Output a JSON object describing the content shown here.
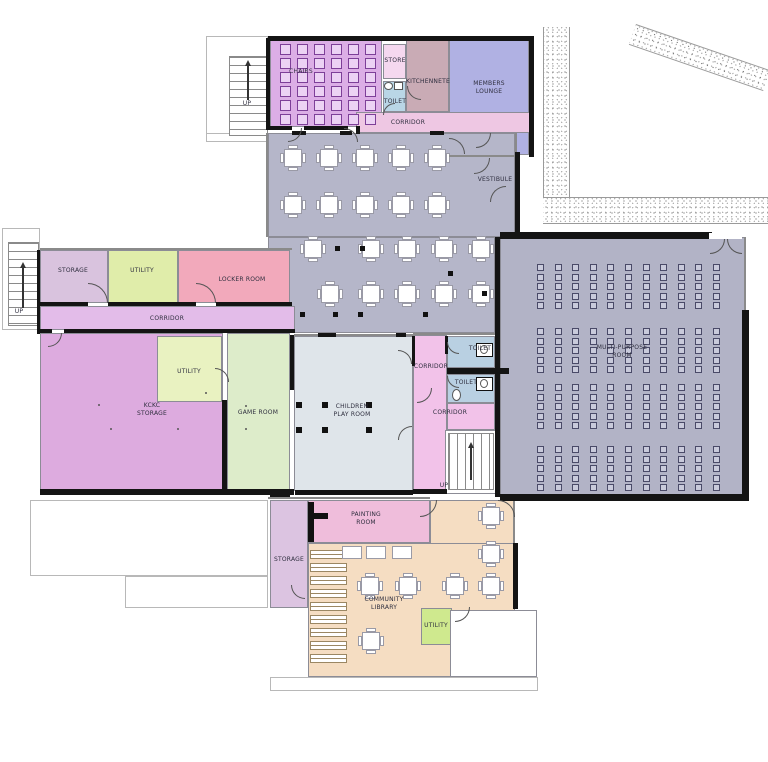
{
  "meta": {
    "width": 768,
    "height": 762,
    "description": "Ground floor plan of a community centre"
  },
  "palette": {
    "hall": "#b5b6c9",
    "multi_purpose": "#b2b3c6",
    "corridor_pink": "#eec7e3",
    "wall": "#141414"
  },
  "rooms": [
    {
      "id": "chairs-room",
      "label": "CHAIRS",
      "x": 270,
      "y": 39,
      "w": 112,
      "h": 88,
      "fill": "#dcaee6",
      "lx": 301,
      "ly": 72
    },
    {
      "id": "store",
      "label": "STORE",
      "x": 383,
      "y": 44,
      "w": 23,
      "h": 35,
      "fill": "#f5d8ef",
      "lx": 395,
      "ly": 61
    },
    {
      "id": "toilet-top",
      "label": "TOILET",
      "x": 383,
      "y": 81,
      "w": 23,
      "h": 31,
      "fill": "#b9d6e6",
      "lx": 395,
      "ly": 102
    },
    {
      "id": "kitchenette",
      "label": "KITCHENNETE",
      "x": 406,
      "y": 40,
      "w": 43,
      "h": 72,
      "fill": "#c9abb5",
      "lx": 428,
      "ly": 82
    },
    {
      "id": "members-lounge",
      "label": "MEMBERS\nLOUNGE",
      "x": 449,
      "y": 40,
      "w": 80,
      "h": 115,
      "fill": "#b0b1e3",
      "lx": 489,
      "ly": 88
    },
    {
      "id": "corridor-top",
      "label": "CORRIDOR",
      "x": 356,
      "y": 112,
      "w": 174,
      "h": 21,
      "fill": "#eec7e3",
      "lx": 408,
      "ly": 123
    },
    {
      "id": "vestibule",
      "label": "VESTIBULE",
      "x": 472,
      "y": 157,
      "w": 46,
      "h": 46,
      "fill": "#f0a2d7",
      "lx": 495,
      "ly": 180
    },
    {
      "id": "hall-upper",
      "label": "",
      "x": 268,
      "y": 133,
      "w": 247,
      "h": 104,
      "fill": "#b5b6c9"
    },
    {
      "id": "hall-lower",
      "label": "",
      "x": 268,
      "y": 237,
      "w": 227,
      "h": 96,
      "fill": "#b5b6c9"
    },
    {
      "id": "multi-purpose-room",
      "label": "MULTI-PURPOSE\nROOM",
      "x": 500,
      "y": 237,
      "w": 245,
      "h": 258,
      "fill": "#b2b3c6",
      "lx": 622,
      "ly": 352
    },
    {
      "id": "storage-mid",
      "label": "STORAGE",
      "x": 40,
      "y": 250,
      "w": 68,
      "h": 53,
      "fill": "#d9c3de",
      "lx": 73,
      "ly": 271
    },
    {
      "id": "utility-mid",
      "label": "UTILITY",
      "x": 108,
      "y": 250,
      "w": 70,
      "h": 53,
      "fill": "#e0edaa",
      "lx": 142,
      "ly": 271
    },
    {
      "id": "locker-room",
      "label": "LOCKER ROOM",
      "x": 178,
      "y": 250,
      "w": 112,
      "h": 53,
      "fill": "#f2a9bb",
      "lx": 242,
      "ly": 280
    },
    {
      "id": "corridor-mid",
      "label": "CORRIDOR",
      "x": 40,
      "y": 306,
      "w": 255,
      "h": 24,
      "fill": "#e3bce9",
      "lx": 167,
      "ly": 319
    },
    {
      "id": "kckc-storage",
      "label": "KCKC\nSTORAGE",
      "x": 40,
      "y": 333,
      "w": 183,
      "h": 157,
      "fill": "#ddabdf",
      "lx": 152,
      "ly": 410
    },
    {
      "id": "utility-kckc",
      "label": "UTILITY",
      "x": 157,
      "y": 336,
      "w": 65,
      "h": 66,
      "fill": "#e9f2c1",
      "lx": 189,
      "ly": 372
    },
    {
      "id": "game-room",
      "label": "GAME ROOM",
      "x": 227,
      "y": 333,
      "w": 63,
      "h": 157,
      "fill": "#ddecca",
      "lx": 258,
      "ly": 413
    },
    {
      "id": "children-play-room",
      "label": "CHILDREN\nPLAY ROOM",
      "x": 294,
      "y": 336,
      "w": 119,
      "h": 155,
      "fill": "#dfe5ea",
      "lx": 352,
      "ly": 411
    },
    {
      "id": "corridor-vertical",
      "label": "CORRIDOR",
      "x": 413,
      "y": 335,
      "w": 34,
      "h": 158,
      "fill": "#f2c2e9",
      "lx": 431,
      "ly": 367
    },
    {
      "id": "toilet-upper",
      "label": "TOILET",
      "x": 447,
      "y": 336,
      "w": 48,
      "h": 32,
      "fill": "#b9d0e2",
      "lx": 480,
      "ly": 349
    },
    {
      "id": "toilet-lower",
      "label": "TOILET",
      "x": 447,
      "y": 374,
      "w": 48,
      "h": 29,
      "fill": "#b9d0e2",
      "lx": 466,
      "ly": 383
    },
    {
      "id": "corridor-lower",
      "label": "CORRIDOR",
      "x": 447,
      "y": 403,
      "w": 48,
      "h": 27,
      "fill": "#f2c2e9",
      "lx": 450,
      "ly": 413
    },
    {
      "id": "stair-room",
      "label": "",
      "x": 445,
      "y": 430,
      "w": 52,
      "h": 64,
      "fill": "#ffffff"
    },
    {
      "id": "painting-room",
      "label": "PAINTING\nROOM",
      "x": 308,
      "y": 500,
      "w": 122,
      "h": 43,
      "fill": "#efbddb",
      "lx": 366,
      "ly": 519
    },
    {
      "id": "storage-bottom",
      "label": "STORAGE",
      "x": 270,
      "y": 500,
      "w": 38,
      "h": 108,
      "fill": "#dcc4e1",
      "lx": 289,
      "ly": 560
    },
    {
      "id": "community-library",
      "label": "COMMUNITY\nLIBRARY",
      "x": 308,
      "y": 543,
      "w": 207,
      "h": 134,
      "fill": "#f5ddc2",
      "lx": 384,
      "ly": 604
    },
    {
      "id": "library-arm",
      "label": "",
      "x": 430,
      "y": 500,
      "w": 85,
      "h": 44,
      "fill": "#f5ddc2"
    },
    {
      "id": "utility-bottom",
      "label": "UTILITY",
      "x": 421,
      "y": 608,
      "w": 31,
      "h": 37,
      "fill": "#cfe98e",
      "lx": 436,
      "ly": 626
    },
    {
      "id": "white-room",
      "label": "",
      "x": 450,
      "y": 610,
      "w": 87,
      "h": 67,
      "fill": "#ffffff"
    }
  ],
  "texts": [
    {
      "id": "up-top",
      "label": "UP",
      "x": 247,
      "y": 104
    },
    {
      "id": "up-left",
      "label": "UP",
      "x": 19,
      "y": 312
    },
    {
      "id": "up-bottom",
      "label": "UP",
      "x": 444,
      "y": 486
    }
  ],
  "decks": [
    [
      206,
      36,
      62,
      102
    ],
    [
      2,
      228,
      38,
      102
    ],
    [
      30,
      500,
      238,
      76
    ],
    [
      125,
      576,
      143,
      32
    ],
    [
      270,
      677,
      268,
      14
    ],
    [
      310,
      666,
      68,
      12
    ],
    [
      206,
      133,
      63,
      9
    ]
  ],
  "masks": [
    [
      709,
      233,
      33,
      6
    ]
  ],
  "stipples": [
    {
      "x": 543,
      "y": 27,
      "w": 27,
      "h": 176,
      "rot": 0,
      "edges": "lr"
    },
    {
      "x": 543,
      "y": 197,
      "w": 225,
      "h": 27,
      "rot": 0,
      "edges": "tb"
    },
    {
      "x": 636,
      "y": 24,
      "w": 142,
      "h": 22,
      "rot": 19,
      "edges": "tb"
    }
  ],
  "walls": [
    [
      268,
      36,
      264,
      5
    ],
    [
      529,
      36,
      5,
      121
    ],
    [
      515,
      152,
      5,
      85
    ],
    [
      266,
      38,
      4,
      92
    ],
    [
      266,
      126,
      26,
      4
    ],
    [
      304,
      126,
      44,
      4
    ],
    [
      356,
      126,
      4,
      8
    ],
    [
      292,
      131,
      14,
      4
    ],
    [
      340,
      131,
      12,
      4
    ],
    [
      430,
      131,
      14,
      4
    ],
    [
      40,
      302,
      48,
      4
    ],
    [
      108,
      302,
      88,
      4
    ],
    [
      216,
      302,
      76,
      4
    ],
    [
      40,
      329,
      12,
      4
    ],
    [
      64,
      329,
      231,
      4
    ],
    [
      37,
      250,
      3,
      84
    ],
    [
      222,
      400,
      5,
      95
    ],
    [
      290,
      335,
      4,
      55
    ],
    [
      40,
      489,
      254,
      6
    ],
    [
      295,
      490,
      118,
      5
    ],
    [
      413,
      489,
      34,
      5
    ],
    [
      500,
      232,
      212,
      7
    ],
    [
      500,
      494,
      249,
      7
    ],
    [
      742,
      310,
      7,
      191
    ],
    [
      495,
      237,
      5,
      260
    ],
    [
      447,
      368,
      62,
      6
    ],
    [
      412,
      336,
      3,
      30
    ],
    [
      445,
      336,
      3,
      18
    ],
    [
      270,
      492,
      20,
      5
    ],
    [
      513,
      543,
      5,
      66
    ],
    [
      318,
      333,
      18,
      4
    ],
    [
      396,
      333,
      10,
      4
    ]
  ],
  "thinlines": [
    [
      744,
      237,
      2,
      76
    ],
    [
      266,
      133,
      2,
      104
    ],
    [
      40,
      248,
      252,
      2
    ],
    [
      449,
      155,
      68,
      2
    ],
    [
      294,
      334,
      120,
      2
    ],
    [
      413,
      333,
      82,
      2
    ],
    [
      515,
      133,
      2,
      22
    ],
    [
      268,
      497,
      162,
      2
    ],
    [
      513,
      500,
      2,
      43
    ]
  ],
  "stairs": [
    {
      "x": 229,
      "y": 56,
      "w": 39,
      "h": 80,
      "dir": "h"
    },
    {
      "x": 8,
      "y": 242,
      "w": 31,
      "h": 84,
      "dir": "h"
    },
    {
      "x": 448,
      "y": 433,
      "w": 46,
      "h": 57,
      "dir": "v"
    }
  ],
  "arrows": [
    {
      "x": 247,
      "y": 60,
      "len": 40
    },
    {
      "x": 22,
      "y": 262,
      "len": 46
    },
    {
      "x": 470,
      "y": 442,
      "len": 38
    }
  ],
  "doors": [
    [
      288,
      128,
      14,
      90
    ],
    [
      344,
      128,
      14,
      0
    ],
    [
      407,
      86,
      14,
      180
    ],
    [
      449,
      138,
      16,
      0
    ],
    [
      474,
      158,
      16,
      90
    ],
    [
      490,
      186,
      16,
      270
    ],
    [
      710,
      239,
      15,
      90
    ],
    [
      727,
      239,
      15,
      180
    ],
    [
      88,
      283,
      20,
      0
    ],
    [
      196,
      283,
      20,
      0
    ],
    [
      48,
      333,
      14,
      90
    ],
    [
      215,
      368,
      14,
      0
    ],
    [
      398,
      350,
      14,
      0
    ],
    [
      398,
      426,
      14,
      270
    ],
    [
      447,
      342,
      12,
      180
    ],
    [
      447,
      376,
      12,
      180
    ],
    [
      417,
      388,
      15,
      90
    ],
    [
      420,
      500,
      17,
      90
    ],
    [
      498,
      500,
      17,
      0
    ],
    [
      291,
      585,
      14,
      180
    ],
    [
      455,
      607,
      15,
      90
    ],
    [
      383,
      103,
      12,
      270
    ],
    [
      476,
      133,
      15,
      90
    ]
  ],
  "furniture": {
    "chairGrid": {
      "x0": 280,
      "dx": 17,
      "cols": 6,
      "y0": 44,
      "dy": 14,
      "rows": 6,
      "size": 11
    },
    "hallTables": {
      "size": 26,
      "rows": [
        {
          "y": 145,
          "xs": [
            280,
            316,
            352,
            388,
            424
          ]
        },
        {
          "y": 192,
          "xs": [
            280,
            316,
            352,
            388,
            424
          ]
        },
        {
          "y": 236,
          "xs": [
            300,
            358,
            394,
            431,
            468
          ]
        },
        {
          "y": 281,
          "xs": [
            317,
            358,
            394,
            431,
            468
          ]
        }
      ]
    },
    "mprSeats": {
      "x0": 537,
      "dx": 17.6,
      "cols": 11,
      "size": 7,
      "dy": 9.6,
      "blocks": [
        {
          "y0": 264,
          "rows": 5
        },
        {
          "y0": 328,
          "rows": 5
        },
        {
          "y0": 384,
          "rows": 5
        },
        {
          "y0": 446,
          "rows": 5
        }
      ]
    },
    "libraryShelves": {
      "x": 310,
      "y0": 550,
      "dy": 13,
      "count": 9,
      "w": 37,
      "h": 9
    },
    "libraryPlainTables": {
      "y": 546,
      "xs": [
        342,
        366,
        392
      ],
      "w": 20,
      "h": 13
    },
    "libraryTables": {
      "size": 26,
      "pts": [
        [
          357,
          573
        ],
        [
          395,
          573
        ],
        [
          442,
          573
        ],
        [
          478,
          503
        ],
        [
          478,
          541
        ],
        [
          478,
          573
        ],
        [
          358,
          628
        ]
      ]
    },
    "columnsHall": [
      [
        335,
        246
      ],
      [
        360,
        246
      ],
      [
        448,
        271
      ],
      [
        482,
        291
      ],
      [
        300,
        312
      ],
      [
        333,
        312
      ],
      [
        358,
        312
      ],
      [
        423,
        312
      ]
    ],
    "columnsPlay": [
      [
        296,
        402
      ],
      [
        322,
        402
      ],
      [
        366,
        402
      ],
      [
        296,
        427
      ],
      [
        322,
        427
      ],
      [
        366,
        427
      ]
    ],
    "dotsSmall": [
      [
        98,
        404
      ],
      [
        110,
        428
      ],
      [
        177,
        428
      ],
      [
        205,
        392
      ],
      [
        245,
        405
      ],
      [
        245,
        428
      ]
    ]
  },
  "fixtures": {
    "wcBoxes": [
      [
        476,
        343
      ],
      [
        476,
        377
      ]
    ],
    "wcOval": [
      452,
      389,
      9,
      12
    ],
    "sinkOval": [
      384,
      82,
      9,
      8
    ],
    "sinkSquare": [
      394,
      82,
      9,
      8
    ],
    "easel": [
      [
        308,
        502,
        6,
        40
      ],
      [
        308,
        513,
        20,
        6
      ]
    ]
  }
}
